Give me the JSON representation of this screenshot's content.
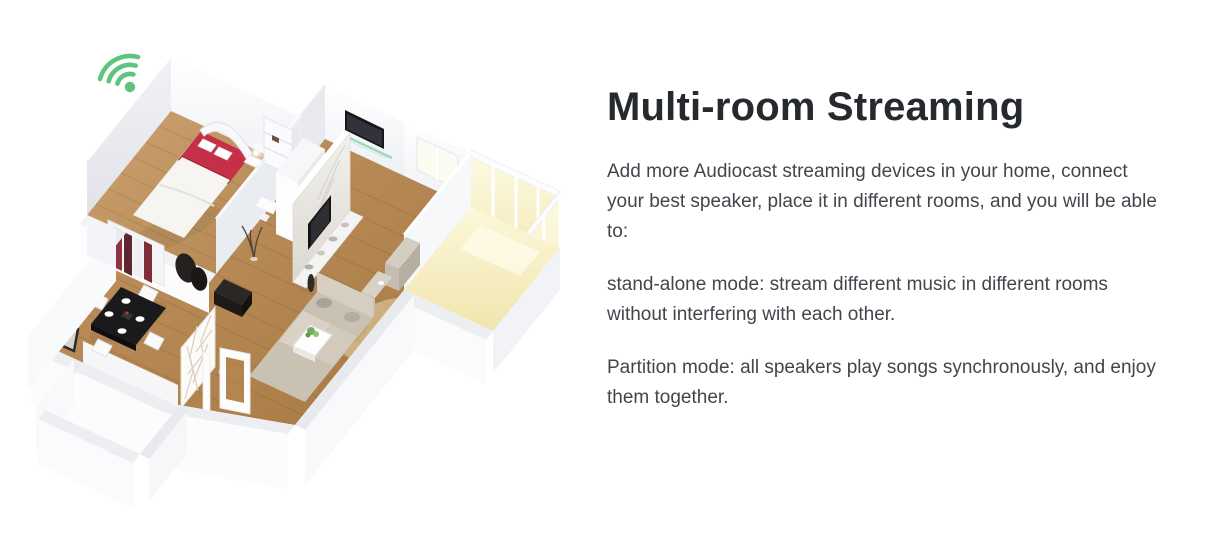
{
  "content": {
    "heading": "Multi-room Streaming",
    "paragraphs": [
      "Add more Audiocast streaming devices in your home, connect your best speaker, place it in different rooms, and you will be able to:",
      "stand-alone mode: stream different music in different rooms without interfering with each other.",
      "Partition mode: all speakers play songs synchronously, and enjoy them together."
    ]
  },
  "illustration": {
    "type": "isometric-3d-floor-plan",
    "icon": "wifi-signal-icon",
    "rooms": [
      "bedroom",
      "hallway",
      "living room",
      "dining area",
      "bathroom",
      "balcony"
    ]
  },
  "colors": {
    "background": "#ffffff",
    "heading_text": "#26292e",
    "body_text": "#42464c",
    "wifi_green": "#5fc57e",
    "wood_floor": "#b5854f",
    "bed_red": "#c53048"
  }
}
